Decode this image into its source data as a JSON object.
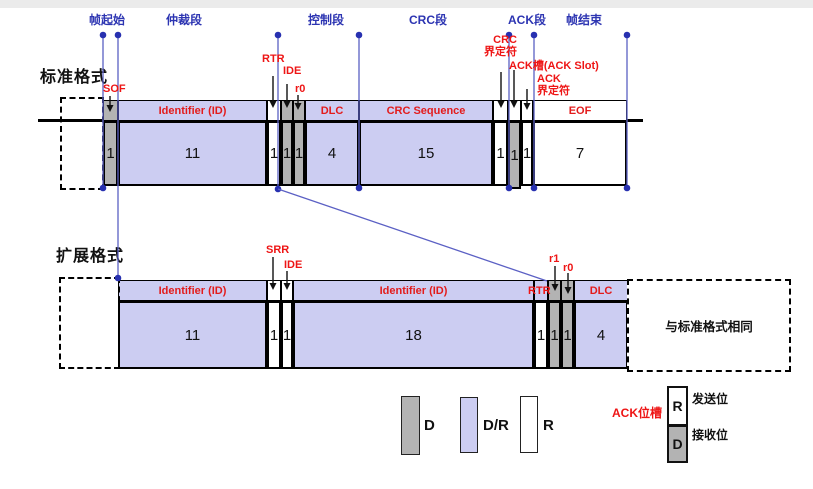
{
  "palette": {
    "lavender": "#cccdf2",
    "gray": "#b3b3b3",
    "white": "#ffffff",
    "blue_line": "#5b60c4",
    "blue_dot": "#2730b0",
    "blue_text": "#2d35b2",
    "red": "#ee1515",
    "black": "#000000"
  },
  "section_labels": [
    {
      "text": "帧起始",
      "cx": 107
    },
    {
      "text": "仲裁段",
      "cx": 184
    },
    {
      "text": "控制段",
      "cx": 326
    },
    {
      "text": "CRC段",
      "cx": 428
    },
    {
      "text": "ACK段",
      "cx": 527
    },
    {
      "text": "帧结束",
      "cx": 584
    }
  ],
  "standard": {
    "title": "标准格式",
    "geom": {
      "band_top": 100,
      "band_h": 21,
      "cell_top": 121,
      "cell_h": 65
    },
    "fields": [
      {
        "id": "sof",
        "band_label": "",
        "bits": "1",
        "type": "D",
        "x": 103,
        "w": 15
      },
      {
        "id": "id",
        "band_label": "Identifier (ID)",
        "bits": "11",
        "type": "DR",
        "x": 118,
        "w": 149
      },
      {
        "id": "rtr",
        "band_label": "",
        "bits": "1",
        "type": "R",
        "x": 267,
        "w": 14
      },
      {
        "id": "ide",
        "band_label": "",
        "bits": "1",
        "type": "D",
        "x": 281,
        "w": 12
      },
      {
        "id": "r0",
        "band_label": "",
        "bits": "1",
        "type": "D",
        "x": 293,
        "w": 12
      },
      {
        "id": "dlc",
        "band_label": "DLC",
        "bits": "4",
        "type": "DR",
        "x": 305,
        "w": 54
      },
      {
        "id": "crc",
        "band_label": "CRC Sequence",
        "bits": "15",
        "type": "DR",
        "x": 359,
        "w": 134
      },
      {
        "id": "crcdel",
        "band_label": "",
        "bits": "1",
        "type": "R",
        "x": 493,
        "w": 15
      },
      {
        "id": "ackslot",
        "band_label": "",
        "bits": "1",
        "type": "ACK",
        "x": 508,
        "w": 13,
        "extra_h": 3
      },
      {
        "id": "ackdel",
        "band_label": "",
        "bits": "1",
        "type": "R",
        "x": 521,
        "w": 12
      },
      {
        "id": "eof",
        "band_label": "EOF",
        "bits": "7",
        "type": "R",
        "x": 533,
        "w": 94
      }
    ]
  },
  "extended": {
    "title": "扩展格式",
    "same_note": "与标准格式相同",
    "geom": {
      "band_top": 280,
      "band_h": 21,
      "cell_top": 301,
      "cell_h": 68
    },
    "fields": [
      {
        "id": "id1",
        "band_label": "Identifier (ID)",
        "bits": "11",
        "type": "DR",
        "x": 118,
        "w": 149
      },
      {
        "id": "srr",
        "band_label": "",
        "bits": "1",
        "type": "R",
        "x": 267,
        "w": 14
      },
      {
        "id": "ide",
        "band_label": "",
        "bits": "1",
        "type": "R",
        "x": 281,
        "w": 12
      },
      {
        "id": "id2",
        "band_label": "Identifier (ID)",
        "bits": "18",
        "type": "DR",
        "x": 293,
        "w": 241
      },
      {
        "id": "rtr",
        "band_label": "",
        "bits": "1",
        "type": "R",
        "x": 534,
        "w": 14,
        "band_bg": "lavender"
      },
      {
        "id": "r1",
        "band_label": "",
        "bits": "1",
        "type": "D",
        "x": 548,
        "w": 13
      },
      {
        "id": "r0",
        "band_label": "",
        "bits": "1",
        "type": "D",
        "x": 561,
        "w": 13
      },
      {
        "id": "dlc",
        "band_label": "DLC",
        "bits": "4",
        "type": "DR",
        "x": 574,
        "w": 54
      }
    ]
  },
  "annotations": [
    {
      "id": "sof-label",
      "lines": [
        "SOF"
      ],
      "x": 103,
      "y": 84
    },
    {
      "id": "rtr-std-label",
      "lines": [
        "RTR"
      ],
      "x": 262,
      "y": 54
    },
    {
      "id": "ide-std-label",
      "lines": [
        "IDE"
      ],
      "x": 283,
      "y": 66
    },
    {
      "id": "r0-std-label",
      "lines": [
        "r0"
      ],
      "x": 295,
      "y": 84
    },
    {
      "id": "crc-delim-label",
      "lines": [
        "CRC",
        "界定符"
      ],
      "x": 471,
      "y": 35,
      "align": "right",
      "w": 46
    },
    {
      "id": "ack-slot-label",
      "lines": [
        "ACK槽(ACK Slot)"
      ],
      "x": 509,
      "y": 61
    },
    {
      "id": "ack-delim-label",
      "lines": [
        "ACK",
        "界定符"
      ],
      "x": 537,
      "y": 74
    },
    {
      "id": "srr-ext-label",
      "lines": [
        "SRR"
      ],
      "x": 266,
      "y": 245
    },
    {
      "id": "ide-ext-label",
      "lines": [
        "IDE"
      ],
      "x": 284,
      "y": 260
    },
    {
      "id": "r1-ext-label",
      "lines": [
        "r1"
      ],
      "x": 549,
      "y": 254
    },
    {
      "id": "r0-ext-label",
      "lines": [
        "r0"
      ],
      "x": 563,
      "y": 263
    },
    {
      "id": "rtr-ext-label",
      "lines": [
        "RTR"
      ],
      "x": 528,
      "y": 286
    }
  ],
  "legend": {
    "swatches": [
      {
        "label": "D",
        "type": "D"
      },
      {
        "label": "D/R",
        "type": "DR"
      },
      {
        "label": "R",
        "type": "R"
      }
    ],
    "ack": {
      "title": "ACK位槽",
      "top_letter": "R",
      "top_label": "发送位",
      "bottom_letter": "D",
      "bottom_label": "接收位"
    }
  }
}
